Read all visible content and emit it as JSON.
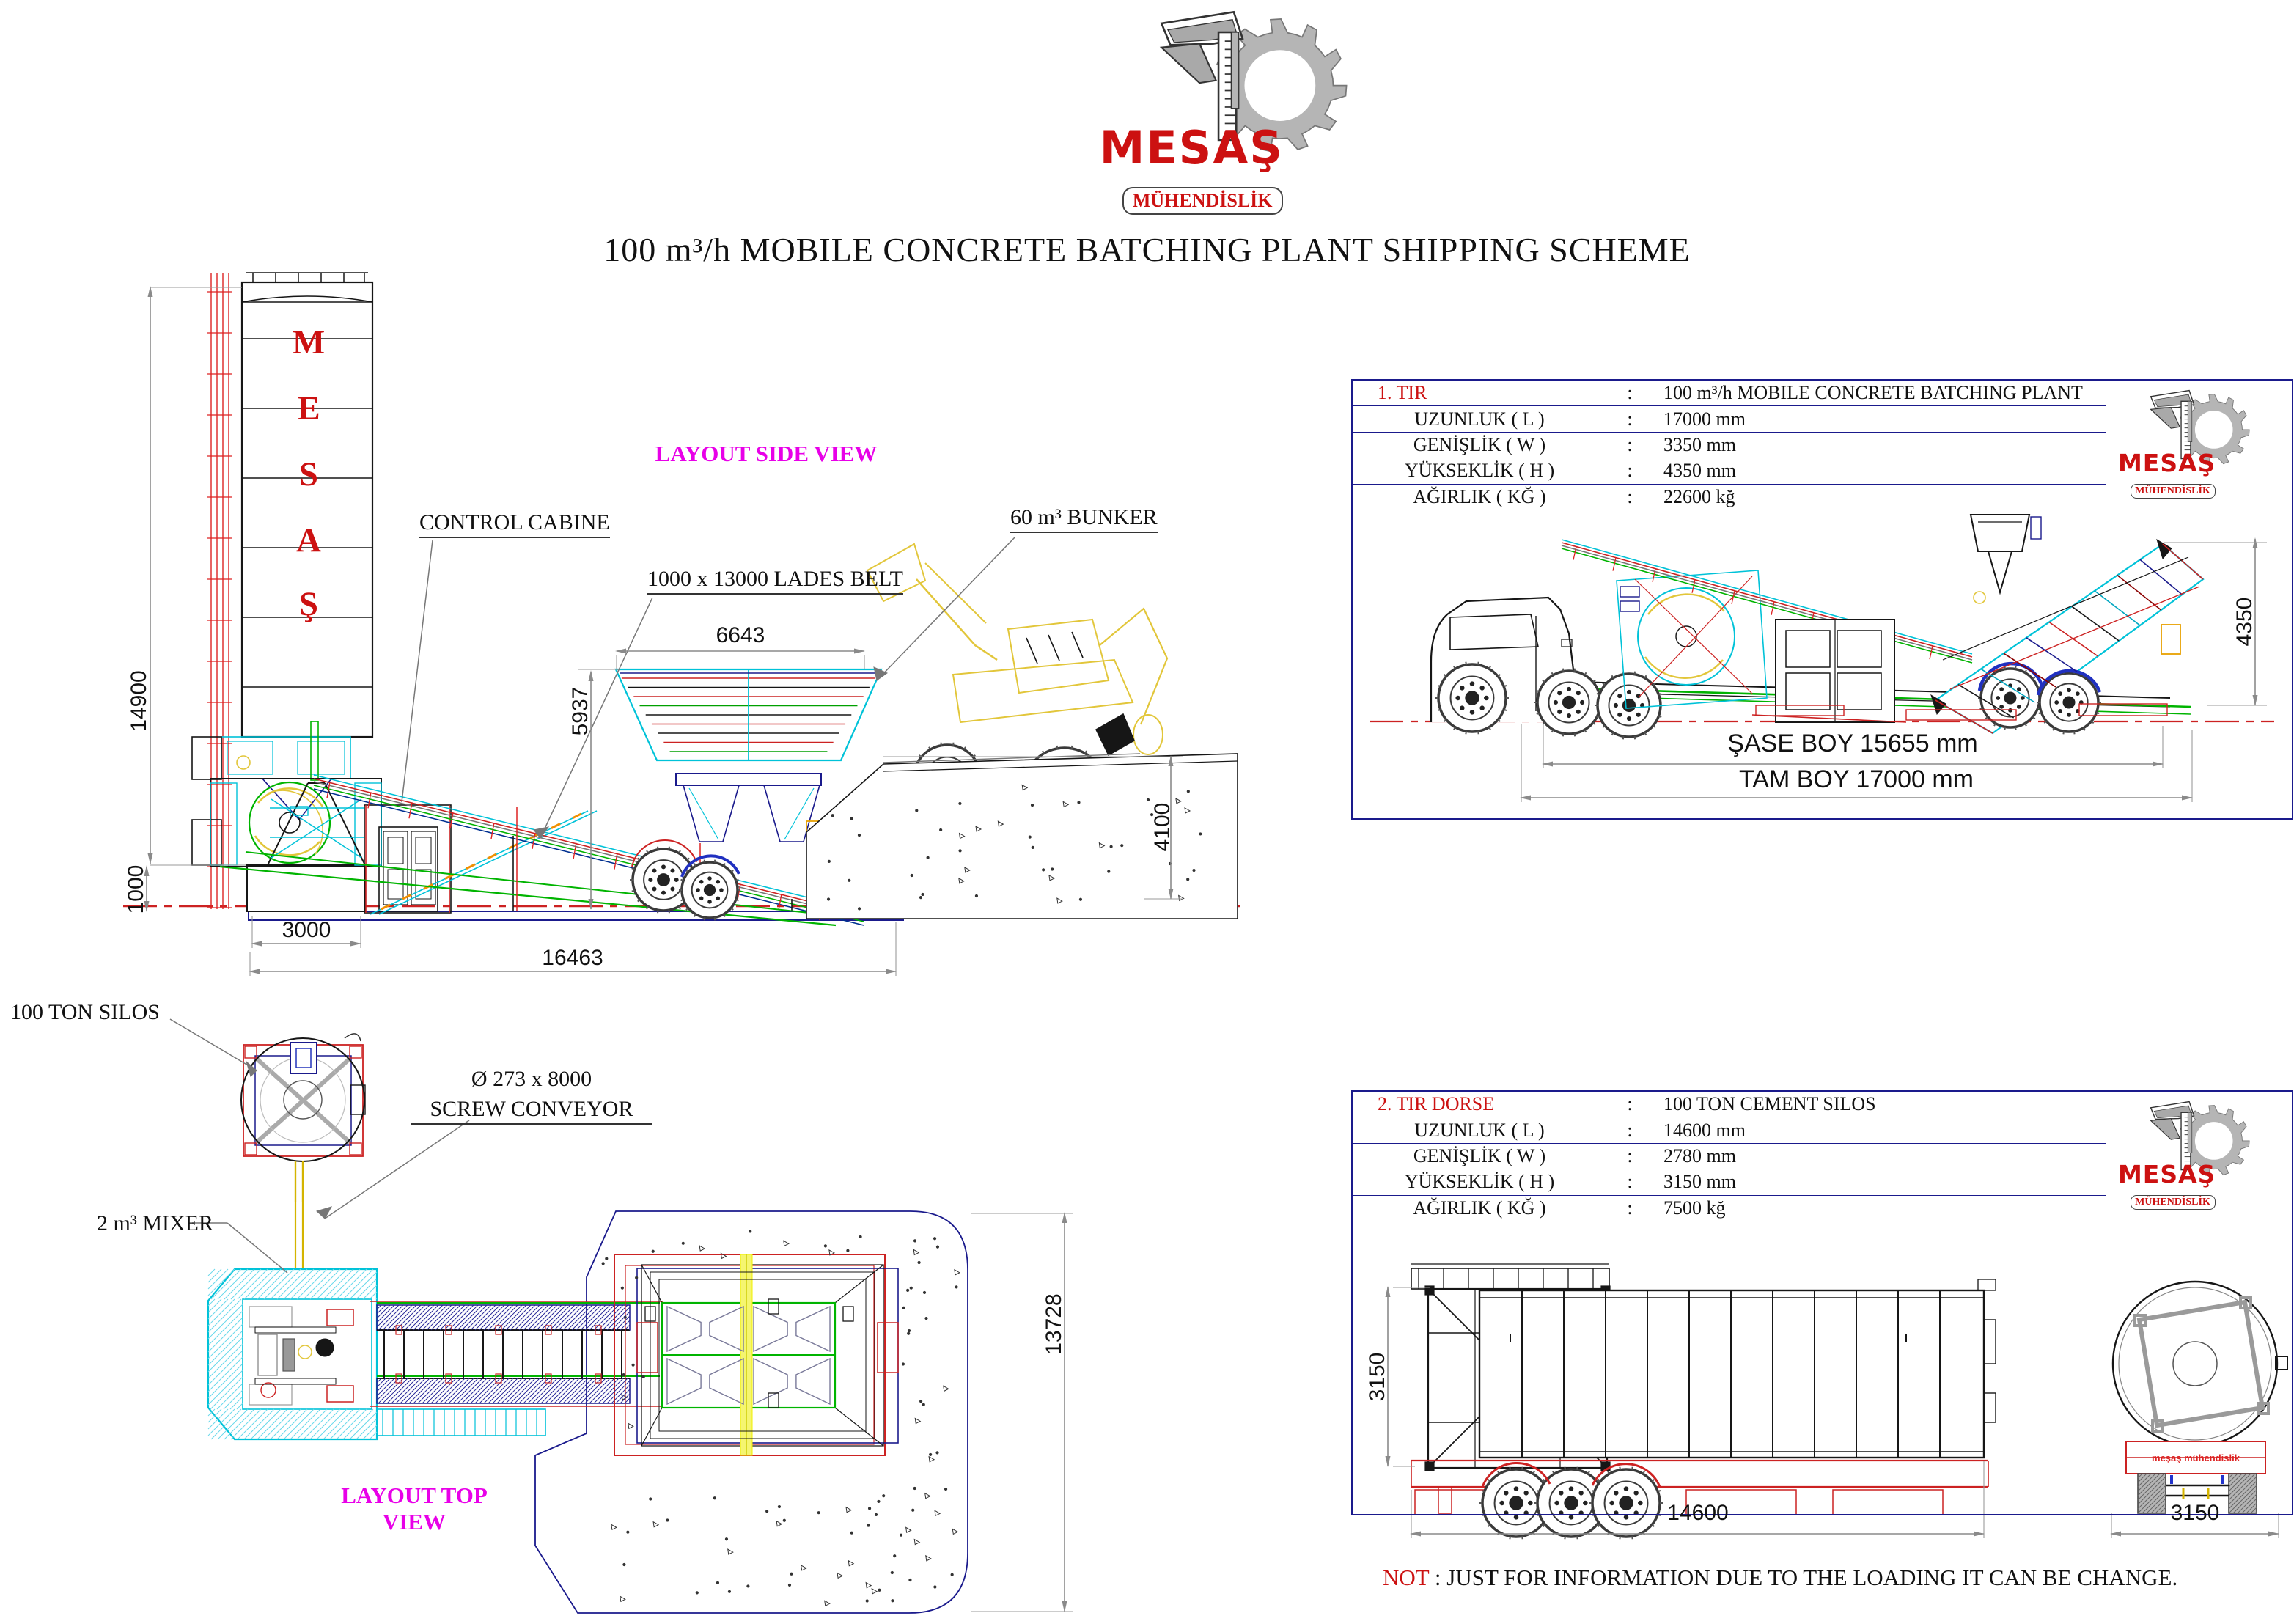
{
  "colors": {
    "accent_red": "#cc1111",
    "magenta": "#e800e8",
    "navy": "#1a1a8c",
    "cyan": "#00c8dc",
    "green": "#00b400",
    "yellow": "#e8c83c",
    "gray": "#9a9a9a",
    "cad_red": "#cc2222"
  },
  "logo": {
    "name": "MESAŞ",
    "subtitle": "MÜHENDİSLİK"
  },
  "title": "100 m³/h MOBILE CONCRETE BATCHING PLANT SHIPPING SCHEME",
  "side_view": {
    "view_label": "LAYOUT SIDE VIEW",
    "silo_letters": [
      "M",
      "E",
      "S",
      "A",
      "Ş"
    ],
    "callouts": {
      "control_cabine": "CONTROL CABINE",
      "lades_belt": "1000 x 13000 LADES BELT",
      "bunker": "60 m³ BUNKER"
    },
    "dims": {
      "total_height": "14900",
      "base_height": "1000",
      "footing_width": "3000",
      "total_length": "16463",
      "bunker_width": "6643",
      "bunker_height": "5937",
      "ramp_height": "4100"
    }
  },
  "top_view": {
    "view_label": "LAYOUT TOP VIEW",
    "callouts": {
      "silos": "100 TON SILOS",
      "screw_size": "Ø 273 x 8000",
      "screw_name": "SCREW CONVEYOR",
      "mixer": "2 m³ MIXER"
    },
    "dims": {
      "plant_width": "13728"
    }
  },
  "panel1": {
    "row0": {
      "label": "1. TIR",
      "colon": ":",
      "value": "100 m³/h MOBILE CONCRETE BATCHING PLANT"
    },
    "rows": [
      {
        "label": "UZUNLUK ( L )",
        "colon": ":",
        "value": "17000 mm"
      },
      {
        "label": "GENİŞLİK ( W )",
        "colon": ":",
        "value": "3350 mm"
      },
      {
        "label": "YÜKSEKLİK ( H )",
        "colon": ":",
        "value": "4350 mm"
      },
      {
        "label": "AĞIRLIK ( KĞ )",
        "colon": ":",
        "value": "22600 kğ"
      }
    ],
    "dims": {
      "chassis_length": "ŞASE BOY 15655 mm",
      "total_length": "TAM BOY 17000 mm",
      "height": "4350"
    }
  },
  "panel2": {
    "row0": {
      "label": "2. TIR DORSE",
      "colon": ":",
      "value": "100 TON CEMENT SILOS"
    },
    "rows": [
      {
        "label": "UZUNLUK ( L )",
        "colon": ":",
        "value": "14600 mm"
      },
      {
        "label": "GENİŞLİK ( W )",
        "colon": ":",
        "value": "2780 mm"
      },
      {
        "label": "YÜKSEKLİK ( H )",
        "colon": ":",
        "value": "3150 mm"
      },
      {
        "label": "AĞIRLIK ( KĞ )",
        "colon": ":",
        "value": "7500 kğ"
      }
    ],
    "trailer_brand": "meşaş mühendislik",
    "dims": {
      "height": "3150",
      "length": "14600",
      "width": "3150"
    }
  },
  "note": {
    "label": "NOT",
    "text": " : JUST FOR INFORMATION DUE TO THE LOADING IT CAN BE CHANGE."
  }
}
